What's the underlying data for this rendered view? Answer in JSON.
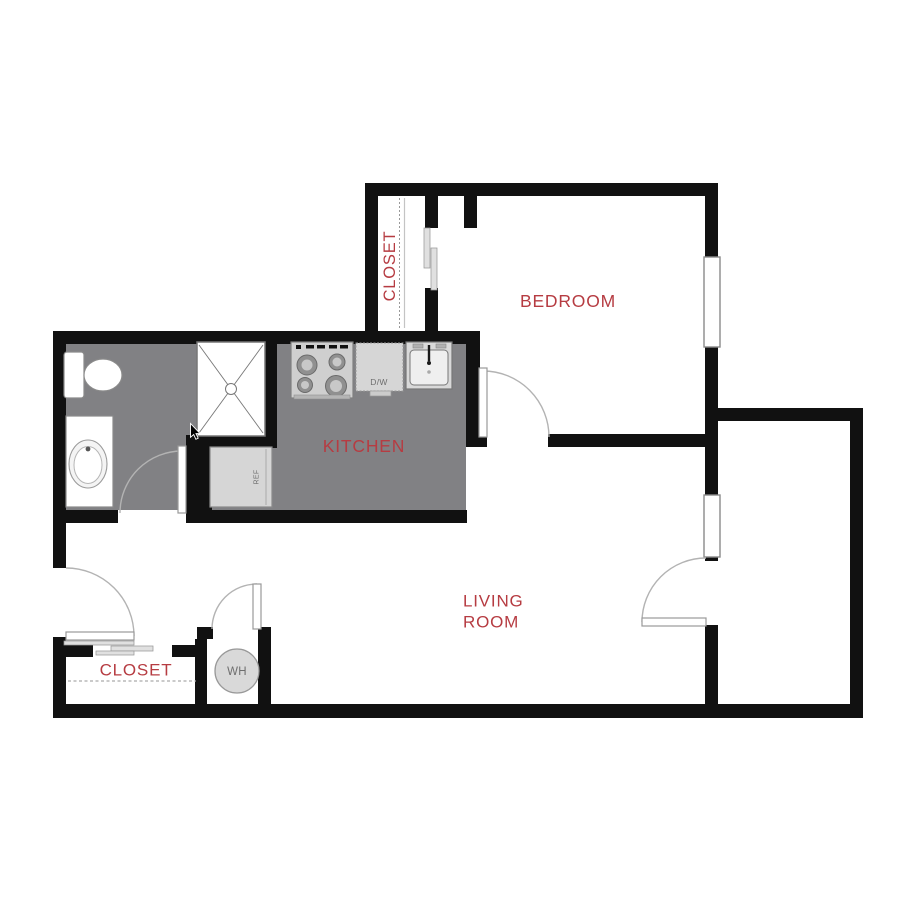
{
  "floor_plan": {
    "title": "apartment-floor-plan",
    "rooms": {
      "bedroom": {
        "label": "BEDROOM"
      },
      "kitchen": {
        "label": "KITCHEN"
      },
      "living_room": {
        "label_line1": "LIVING",
        "label_line2": "ROOM"
      },
      "bedroom_closet": {
        "label": "CLOSET"
      },
      "entry_closet": {
        "label": "CLOSET"
      }
    },
    "fixtures": {
      "dishwasher": {
        "label": "D/W"
      },
      "refrigerator": {
        "label": "REF"
      },
      "water_heater": {
        "label": "WH"
      }
    },
    "colors": {
      "wall": "#111111",
      "floor": "#818184",
      "label": "#b63c42"
    }
  }
}
